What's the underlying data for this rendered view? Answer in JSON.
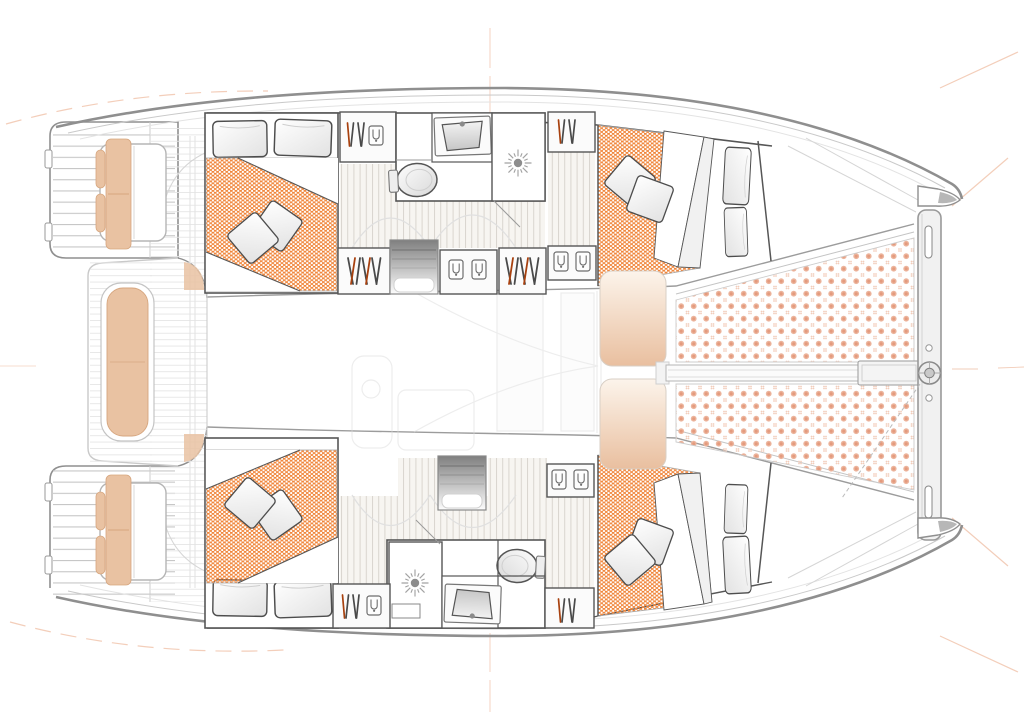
{
  "drawing": {
    "kind": "boat-deck-plan",
    "subject": "Sailing catamaran overhead accommodation and deck layout, bow to the right",
    "background": "#ffffff"
  },
  "colors": {
    "outline": "#8f8f8f",
    "outline_soft": "#c9c9c9",
    "wall": "#565656",
    "deck_line": "#e6e6e6",
    "floor_base": "#f7f5f1",
    "floor_line": "#d9d5cf",
    "mattress": "#f0873d",
    "trampoline": "#ecb49c",
    "trampoline_core": "#e49a7d",
    "cushion": "#e9c2a2",
    "cushion_border": "#d6a67f",
    "hanger": "#4a4a4a",
    "hanger_accent": "#a8410f",
    "stair_dark": "#7f7f7f",
    "ghost": "#dcdcdc",
    "mark": "#e9a682",
    "pillow_edge": "#4d4d4d"
  },
  "labels": {
    "plan": "Catamaran deck and accommodation plan, overhead view, bow to the right",
    "registration_marks": "Drawing registration marks",
    "port_transom": "Port transom swim platform with steps",
    "starboard_transom": "Starboard transom swim platform with steps",
    "cockpit": "Aft cockpit deck",
    "helm_seat_port": "Port helm seat with cushion",
    "helm_seat_starboard": "Starboard helm seat with cushion",
    "cockpit_bench": "Central cockpit bench cushion",
    "saloon_ghost": "Saloon furniture shown ghosted under deck",
    "port_hull": "Port hull accommodation",
    "starboard_hull": "Starboard hull accommodation",
    "port_aft_cabin": "Port aft double cabin",
    "port_forward_cabin": "Port forward double cabin",
    "starboard_aft_cabin": "Starboard aft double cabin",
    "starboard_forward_cabin": "Starboard forward double cabin",
    "port_bathroom": "Port bathroom with washbasin, toilet and shower",
    "starboard_bathroom": "Starboard bathroom with shower, washbasin and toilet",
    "port_stairs": "Port hull companionway steps",
    "starboard_stairs": "Starboard hull companionway steps",
    "sunpad_port": "Port foredeck sun cushion",
    "sunpad_starboard": "Starboard foredeck sun cushion",
    "trampoline_port": "Port trampoline net panel",
    "trampoline_starboard": "Starboard trampoline net panel",
    "crossbeam": "Forward crossbeam",
    "longitudinal_beam": "Center longitudinal beam",
    "bowsprit_fitting": "Bowsprit attachment fitting"
  },
  "inventory": {
    "double_cabins": 4,
    "bathrooms": 2,
    "toilets": 2,
    "showers": 2,
    "washbasins": 2,
    "companionways": 2,
    "double_berths": 4,
    "pillows": 8,
    "scatter_cushions": 8,
    "wardrobes": 6,
    "helm_seats": 2,
    "cockpit_benches": 1,
    "sun_pads": 2,
    "trampoline_panels": 2,
    "transom_platforms": 2
  }
}
